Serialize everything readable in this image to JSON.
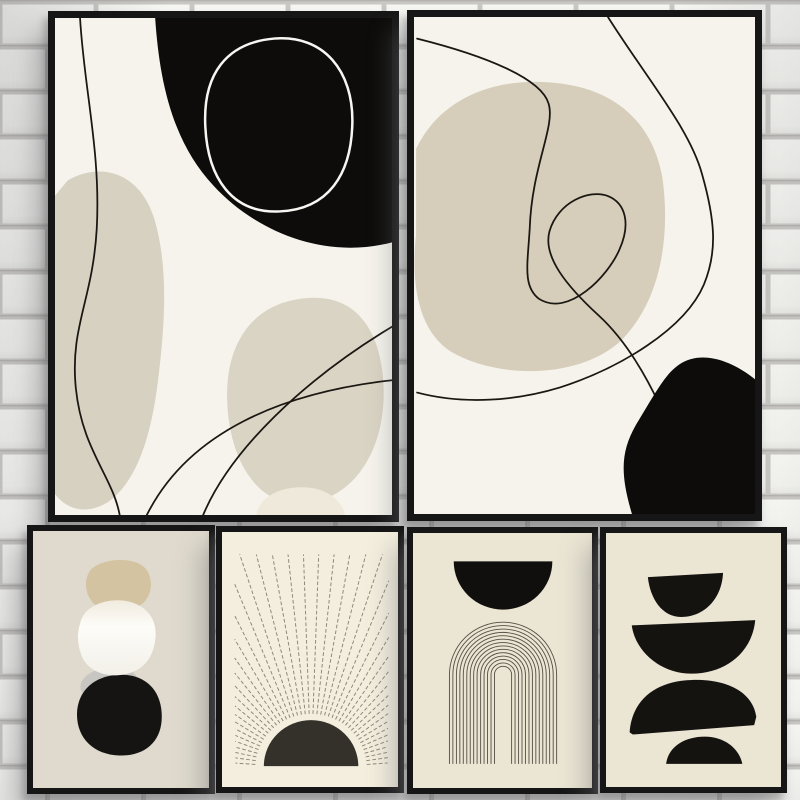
{
  "scene": {
    "type": "product-photo",
    "description": "Gallery wall: six black-framed mid-century abstract boho posters hung on a white painted brick wall. Two large portrait posters on top, four small portrait posters below.",
    "wall": {
      "brick_color": "#f5f5f2",
      "brick_shade": "#e9e9e6",
      "mortar_color": "#c9c8c5",
      "mortar_shadow": "#b4b3b0"
    },
    "frame_color": "#161616"
  },
  "posters": [
    {
      "id": "top-left",
      "name": "abstract organic shapes with black blob, white ring and curved lines",
      "palette": {
        "bg": "#f5f3ec",
        "beige": "#d7d1c1",
        "beige2": "#dad4c4",
        "pale": "#eee9da",
        "black": "#0d0c0a",
        "line": "#1a1713",
        "ring": "#f7f6f2"
      }
    },
    {
      "id": "top-right",
      "name": "abstract beige blob with looping single-line drawing and corner black blob",
      "palette": {
        "bg": "#f5f3ec",
        "beige": "#d6ceba",
        "black": "#0d0c0a",
        "line": "#1a1713"
      }
    },
    {
      "id": "bottom-stones",
      "name": "stacked organic pebbles: tan, white, gray, black",
      "palette": {
        "bg": "#dfdacd",
        "tan": "#d3c3a1",
        "white": "#fdfcf8",
        "white_edge": "#efe9dc",
        "gray": "#c7c6c3",
        "black": "#161412"
      }
    },
    {
      "id": "bottom-sun",
      "name": "woodblock sunrise: black half sun with radiating stippled rays",
      "palette": {
        "bg": "#f3eede",
        "ray": "#8e8678",
        "sun": "#34312b"
      },
      "rays": {
        "count": 44,
        "angle_start": 4,
        "angle_end": 176,
        "inner_radius": 52
      }
    },
    {
      "id": "bottom-arch",
      "name": "black half circle over concentric line arch (rainbow)",
      "palette": {
        "bg": "#ebe5d4",
        "line": "#564f45",
        "black": "#100f0d"
      },
      "arch": {
        "arcs": 14,
        "r_min": 8,
        "r_max": 50,
        "cx": 84,
        "spring_y": 135,
        "base_y": 220
      }
    },
    {
      "id": "bottom-semicircles",
      "name": "balancing black bowls and domes stack",
      "palette": {
        "bg": "#ebe5d4",
        "black": "#151310"
      }
    }
  ]
}
